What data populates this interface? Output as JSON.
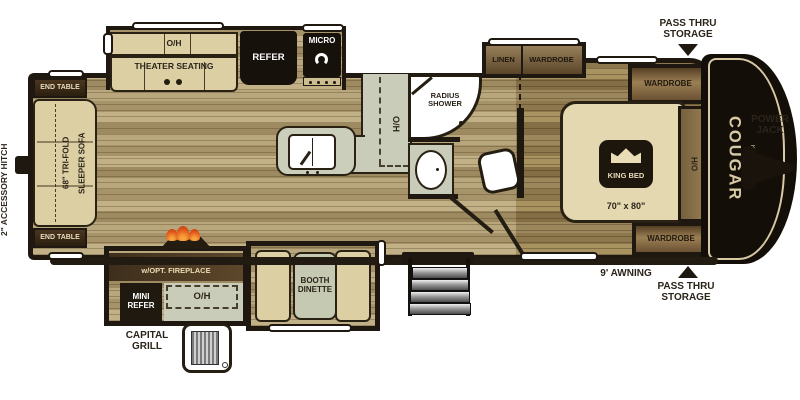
{
  "colors": {
    "wall": "#1f1810",
    "floor_light": "#b3a075",
    "floor_dark": "#9c875c",
    "counter_sage": "#c9ccb8",
    "furniture_tan": "#dccfa4",
    "cabinet_brown": "#6b5435",
    "appliance_black": "#17110b",
    "flame_orange": "#e8651f",
    "brand_cream": "#d6c9a4"
  },
  "exterior": {
    "hitch_label": "2\" ACCESSORY HITCH",
    "power_jack_line1": "POWER",
    "power_jack_line2": "JACK",
    "pass_thru_top_line1": "PASS THRU",
    "pass_thru_top_line2": "STORAGE",
    "pass_thru_bottom_line1": "PASS THRU",
    "pass_thru_bottom_line2": "STORAGE",
    "awning_label": "9' AWNING",
    "grill_label_line1": "CAPITAL",
    "grill_label_line2": "GRILL",
    "brand": "COUGAR",
    "brand_sub": "HALF-TON"
  },
  "rear_lounge": {
    "end_table_top": "END TABLE",
    "end_table_bottom": "END TABLE",
    "sofa_line1": "68\" TRI-FOLD",
    "sofa_line2": "SLEEPER SOFA"
  },
  "galley": {
    "theater_overhead": "O/H",
    "theater_seating": "THEATER SEATING",
    "refrigerator": "REFER",
    "microwave": "MICRO",
    "counter_overhead": "O/H"
  },
  "bathroom": {
    "shower_line1": "RADIUS",
    "shower_line2": "SHOWER"
  },
  "bedroom": {
    "linen": "LINEN",
    "wardrobe_bump": "WARDROBE",
    "wardrobe_top": "WARDROBE",
    "wardrobe_bottom": "WARDROBE",
    "king_bed": "KING BED",
    "bed_size": "70\" x 80\"",
    "headboard_overhead": "H/O"
  },
  "door_side": {
    "ent_center_line1": "ENT. CENTER",
    "ent_center_line2": "w/OPT. FIREPLACE",
    "mini_refer_line1": "MINI",
    "mini_refer_line2": "REFER",
    "kitchen_overhead": "O/H",
    "dinette_line1": "BOOTH",
    "dinette_line2": "DINETTE"
  }
}
